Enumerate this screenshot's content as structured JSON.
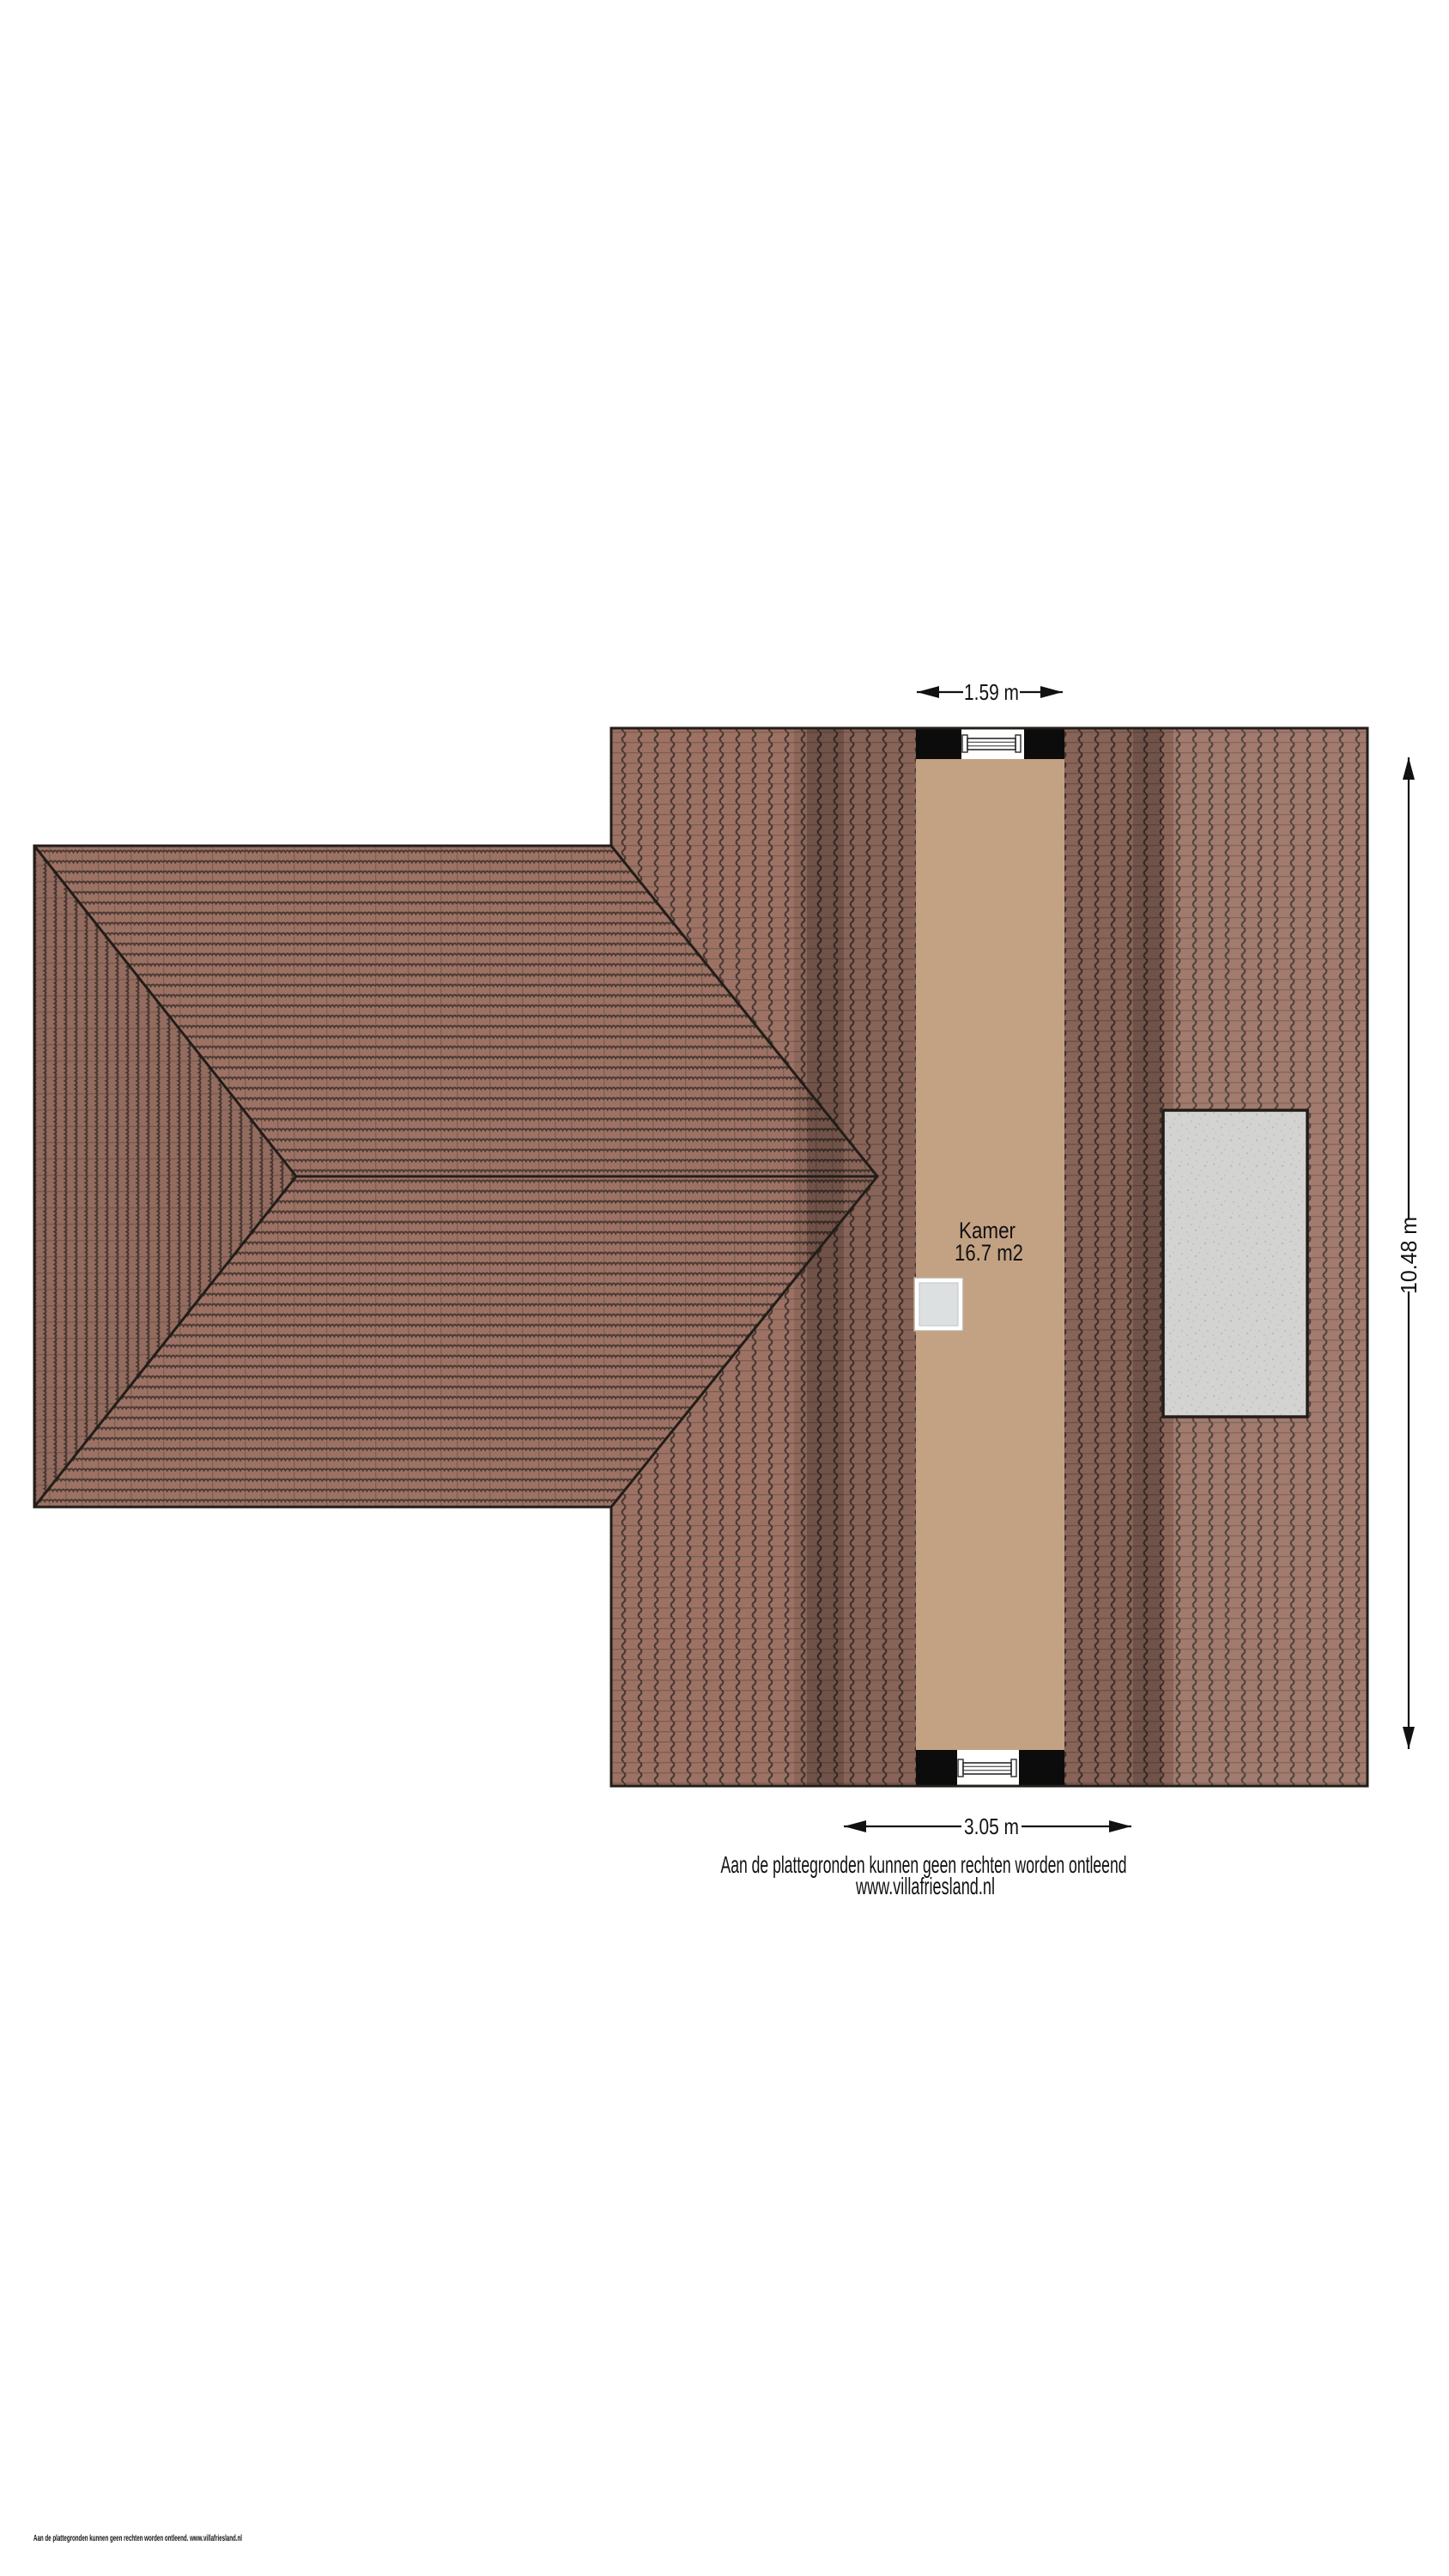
{
  "floorplan": {
    "room": {
      "name": "Kamer",
      "area": "16.7 m2"
    },
    "dimensions": {
      "dormer_width_top": "1.59 m",
      "dormer_width_bottom": "3.05 m",
      "roof_length_right": "10.48 m"
    },
    "disclaimer": {
      "line1": "Aan de plattegronden kunnen geen rechten worden ontleend",
      "line2": "www.villafriesland.nl"
    },
    "footer_note": "Aan de plattegronden kunnen geen rechten worden ontleend. www.villafriesland.nl"
  },
  "colors": {
    "background": "#ffffff",
    "tile_base": "#9d7265",
    "tile_joint_dark": "#4a3a32",
    "tile_joint_mid": "#7b5f53",
    "room_fill": "#c3a283",
    "outline": "#221d19",
    "dormer_black": "#0c0c0c",
    "window_white": "#ffffff",
    "window_frame": "#2a2a2a",
    "skylight_glass": "#dce0e0",
    "concrete_fill": "#d3d3d1",
    "concrete_speck": "#bcbcba",
    "dimension": "#111111",
    "text": "#111111"
  }
}
